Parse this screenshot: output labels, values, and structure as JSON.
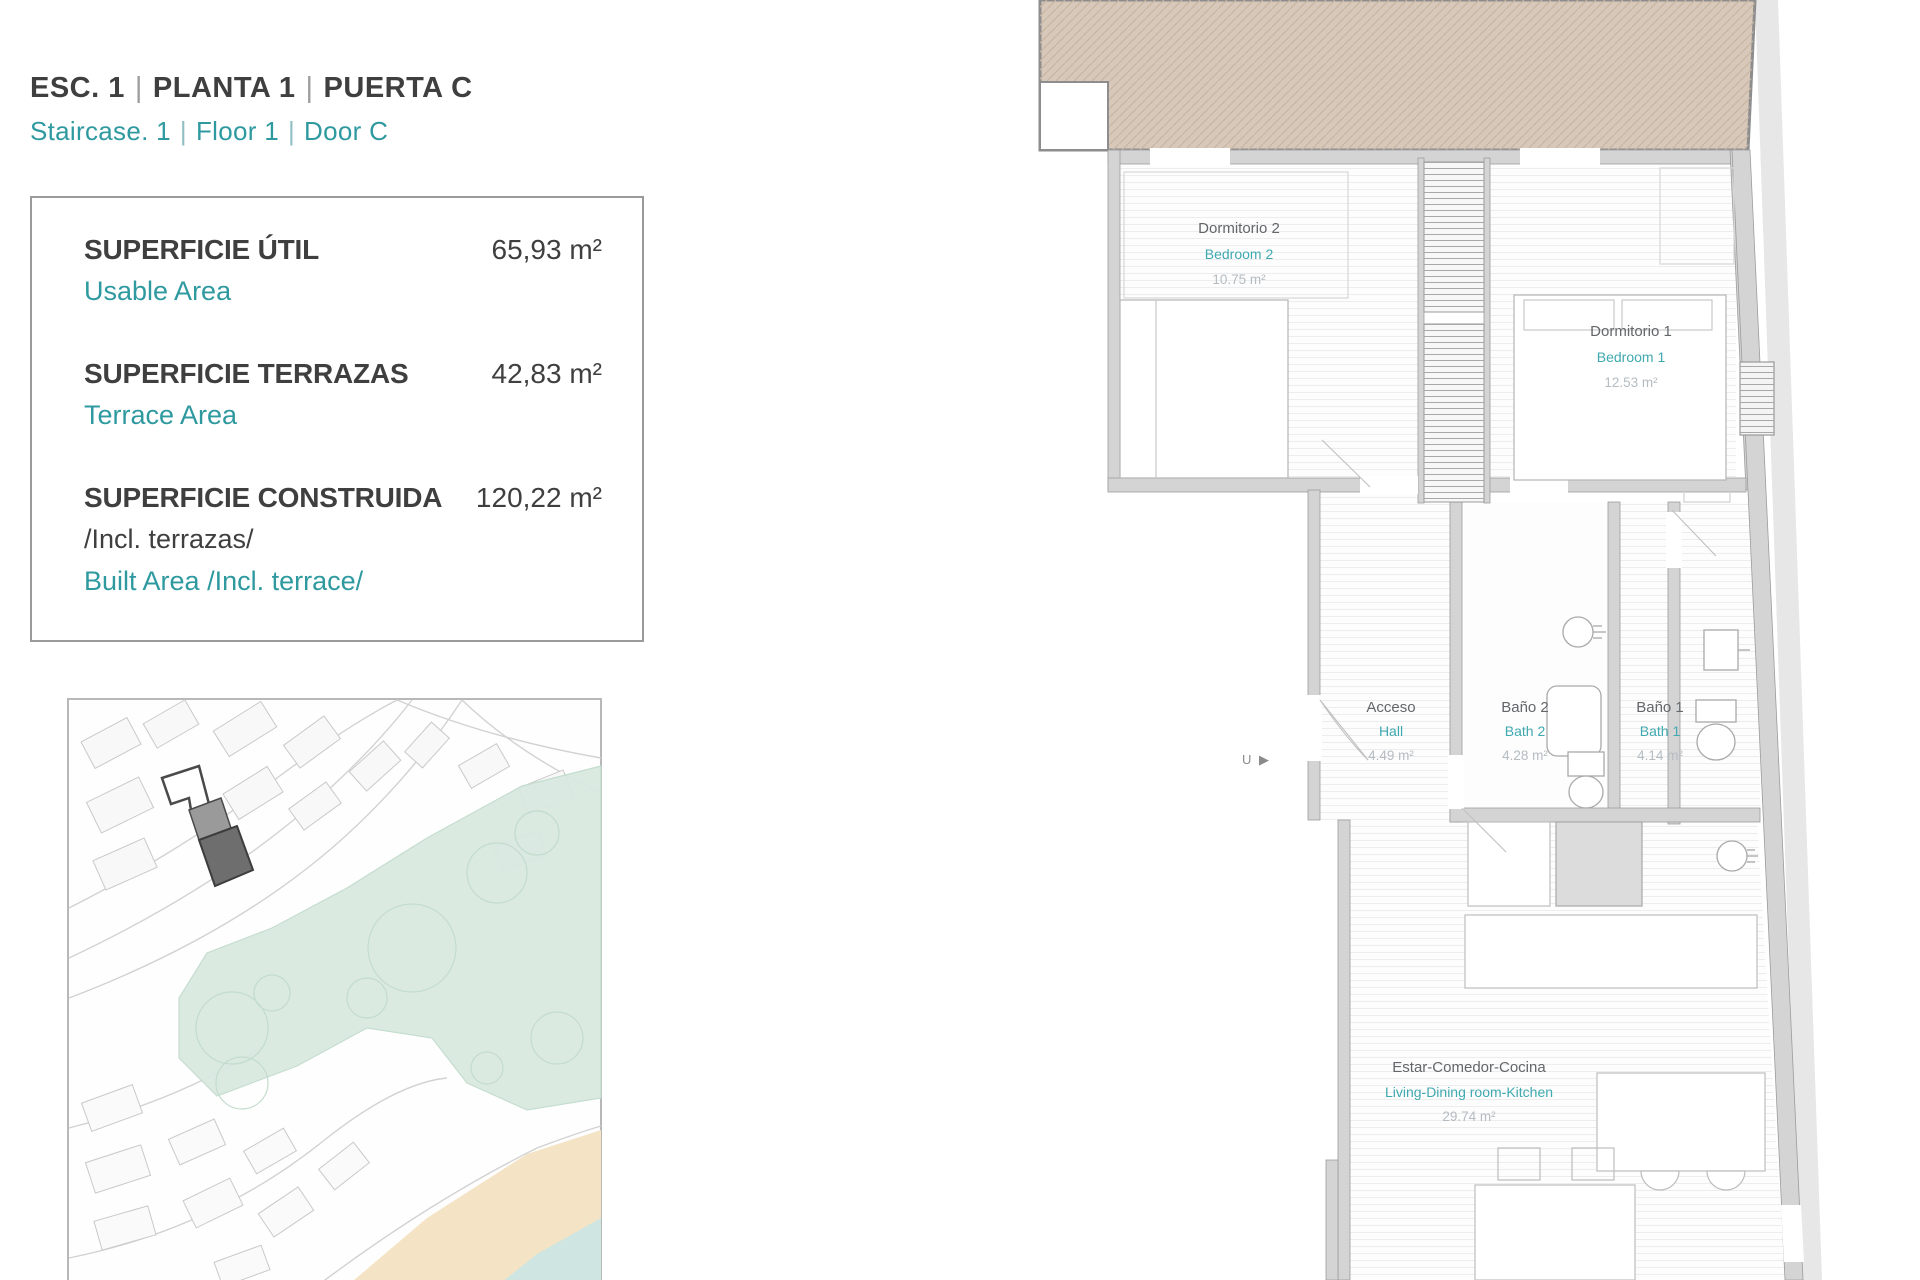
{
  "header": {
    "sep": "|",
    "title_es": [
      "ESC. 1",
      "PLANTA  1",
      "PUERTA C"
    ],
    "title_en": [
      "Staircase. 1",
      "Floor  1",
      "Door C"
    ]
  },
  "areas": [
    {
      "label_es": "SUPERFICIE ÚTIL",
      "label_en": "Usable Area",
      "value": "65,93 m²"
    },
    {
      "label_es": "SUPERFICIE TERRAZAS",
      "label_en": "Terrace Area",
      "value": "42,83 m²"
    },
    {
      "label_es": "SUPERFICIE CONSTRUIDA",
      "label_es2": "/Incl. terrazas/",
      "label_en": "Built Area /Incl. terrace/",
      "value": "120,22 m²"
    }
  ],
  "rooms": [
    {
      "name_es": "Dormitorio 2",
      "name_en": "Bedroom 2",
      "area": "10.75 m²"
    },
    {
      "name_es": "Dormitorio 1",
      "name_en": "Bedroom 1",
      "area": "12.53 m²"
    },
    {
      "name_es": "Acceso",
      "name_en": "Hall",
      "area": "4.49 m²"
    },
    {
      "name_es": "Baño 2",
      "name_en": "Bath 2",
      "area": "4.28 m²"
    },
    {
      "name_es": "Baño 1",
      "name_en": "Bath 1",
      "area": "4.14 m²"
    },
    {
      "name_es": "Estar-Comedor-Cocina",
      "name_en": "Living-Dining room-Kitchen",
      "area": "29.74 m²"
    }
  ],
  "plan": {
    "entry_symbol": "U ▶"
  },
  "colors": {
    "accent_teal": "#2f99a0",
    "terrace_tan": "#d8c8b9",
    "terrace_hatch": "#c7b5a4",
    "wall_gray": "#d4d4d4",
    "wall_edge": "#9c9c9c",
    "map_green": "#d9e9e0",
    "map_sand": "#f4e4c5",
    "map_water": "#cfe5e1",
    "map_highlight": "#6e6e6e"
  }
}
